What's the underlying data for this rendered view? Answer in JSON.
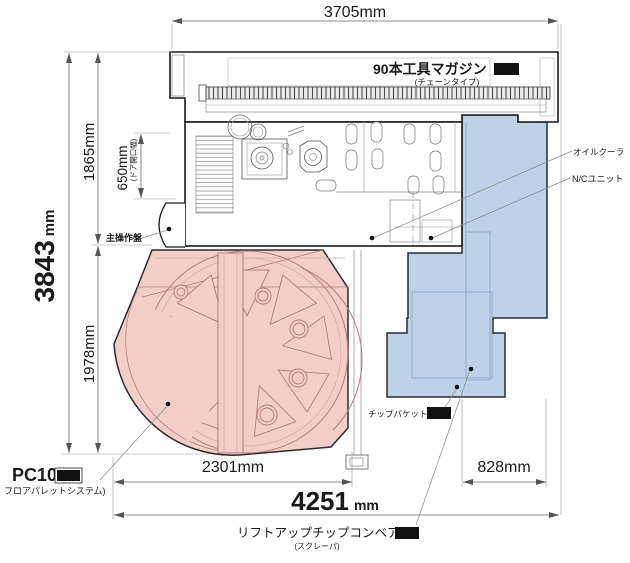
{
  "colors": {
    "pallet_pink": "#f3cec9",
    "pallet_line": "#b07f79",
    "unit_blue": "#bdd2e9",
    "unit_line": "#8fa6c2",
    "outline": "#1a1a1a",
    "dim_line": "#666666",
    "badge_bg": "#111111",
    "badge_text": "#ffffff"
  },
  "dims": {
    "top_width": "3705mm",
    "total_height": "3843",
    "total_height_unit": "mm",
    "upper_height": "1865mm",
    "lower_height": "1978mm",
    "door_opening": "650mm",
    "door_opening_note": "(ドア開口幅)",
    "pallet_width": "2301mm",
    "right_width": "828mm",
    "total_width": "4251",
    "total_width_unit": "mm"
  },
  "labels": {
    "tool_magazine": "90本工具マガジン",
    "tool_magazine_type": "(チェーンタイプ)",
    "oil_cooler": "オイルクーラ",
    "nc_unit": "N/Cユニット",
    "chip_bucket": "チップバケット",
    "chip_conveyor": "リフトアップチップコンベア",
    "chip_conveyor_type": "(スクレーパ)",
    "main_panel": "主操作盤",
    "pallet_system": "PC10",
    "pallet_system_note": "フロアパレットシステム)"
  },
  "badges": {
    "opt_magazine": "OPT",
    "opt_bucket": "OPT",
    "opt_conveyor": "OPT",
    "std_pallet": "STD"
  }
}
